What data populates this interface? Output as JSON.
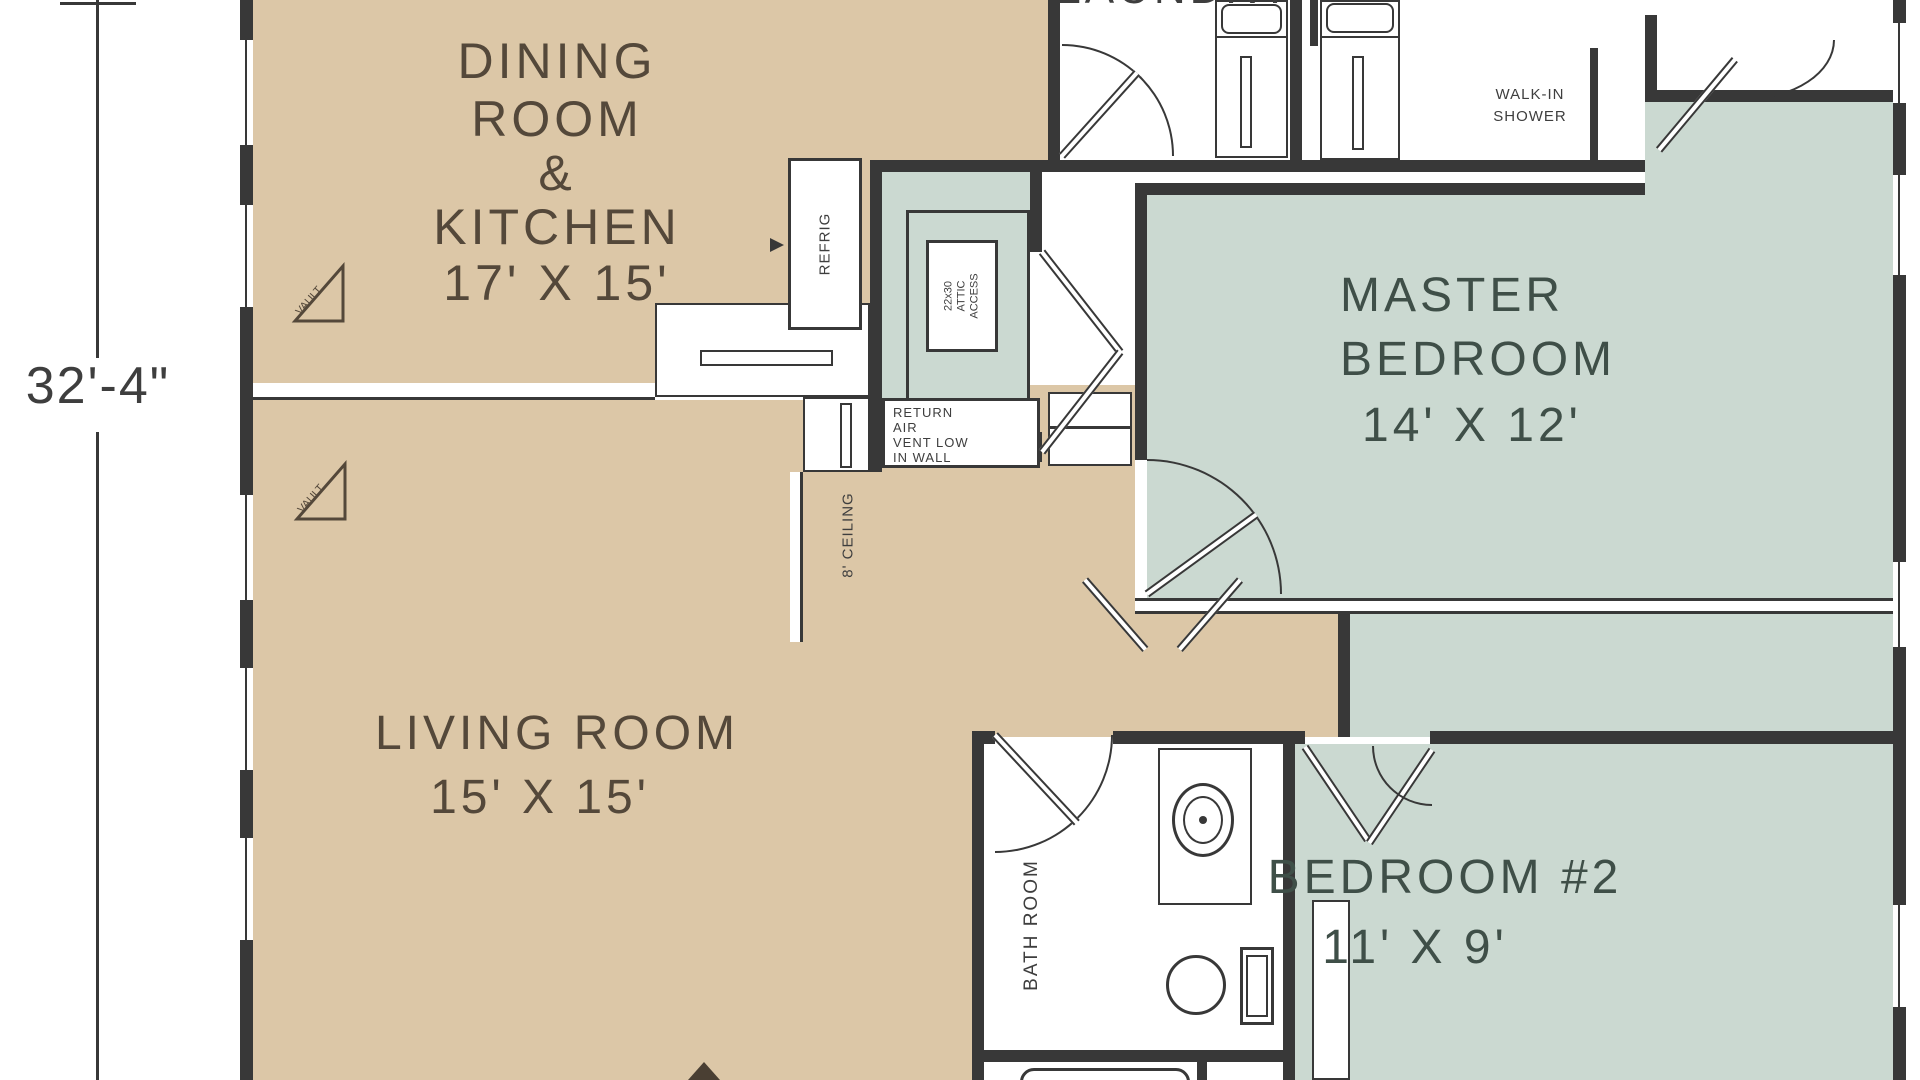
{
  "colors": {
    "room_tan": "#dcc7a7",
    "room_teal": "#cbd9d1",
    "wall": "#383838",
    "text_brown": "#54483a",
    "text_teal_dark": "#3f4f48",
    "text_gray": "#3e3e3e"
  },
  "dimension": {
    "height_label": "32'-4\""
  },
  "rooms": {
    "dining_kitchen": {
      "line1": "DINING",
      "line2": "ROOM",
      "line3": "&",
      "line4": "KITCHEN",
      "size": "17' X 15'"
    },
    "living": {
      "name": "LIVING ROOM",
      "size": "15' X 15'"
    },
    "master": {
      "line1": "MASTER",
      "line2": "BEDROOM",
      "size": "14' X 12'"
    },
    "bedroom2": {
      "name": "BEDROOM #2",
      "size": "11' X 9'"
    },
    "laundry": {
      "name": "LAUNDRY"
    },
    "bathroom": {
      "name": "BATH ROOM"
    }
  },
  "labels": {
    "walk_in_line1": "WALK-IN",
    "walk_in_line2": "SHOWER",
    "refrigerator": "REFRIG",
    "attic_line1": "22x30",
    "attic_line2": "ATTIC",
    "attic_line3": "ACCESS",
    "return_air_line1": "RETURN",
    "return_air_line2": "AIR",
    "return_air_line3": "VENT LOW",
    "return_air_line4": "IN WALL",
    "ceiling_height": "8' CEILING",
    "vault_dining": "VAULT",
    "vault_living": "VAULT"
  }
}
